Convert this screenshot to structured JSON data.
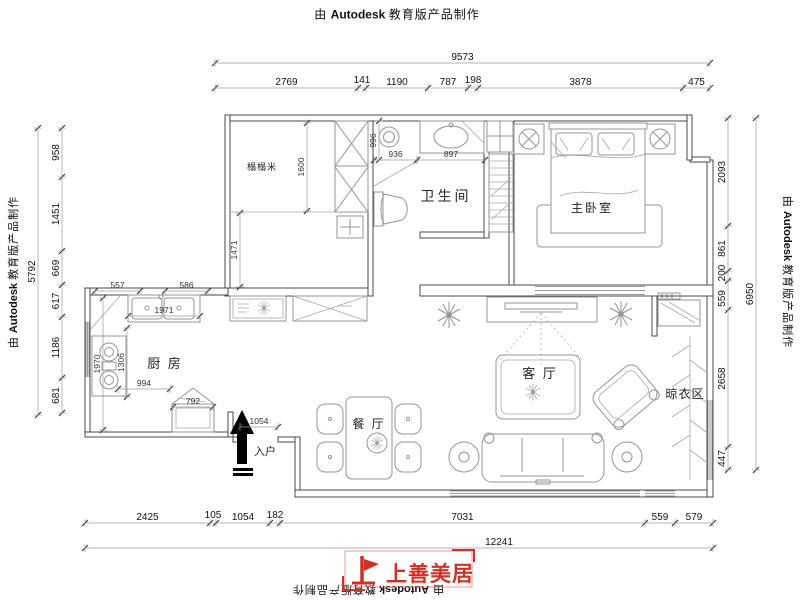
{
  "credit": {
    "pre": "由",
    "brand": "Autodesk",
    "post": "教育版产品制作"
  },
  "logo": {
    "name": "上善美居"
  },
  "rooms": {
    "tatami": "榻榻米",
    "bath": "卫生间",
    "master": "主卧室",
    "kitchen": "厨 房",
    "living": "客 厅",
    "dining": "餐 厅",
    "drying": "晾衣区",
    "entry": "入户"
  },
  "dims": {
    "top_total": "9573",
    "top": [
      "2769",
      "141",
      "1190",
      "787",
      "198",
      "3878",
      "475"
    ],
    "left_total": "5792",
    "left": [
      "958",
      "1451",
      "669",
      "617",
      "1186",
      "681"
    ],
    "right_total": "6950",
    "right": [
      "2093",
      "861",
      "200",
      "559",
      "2658",
      "447"
    ],
    "bottom_total": "12241",
    "bottom": [
      "2425",
      "105",
      "1054",
      "182",
      "7031",
      "559",
      "579"
    ],
    "inner": {
      "tatami_depth": "1600",
      "hall": "1471",
      "bath_w": "996",
      "shower": "936",
      "basin": "897",
      "k_a": "557",
      "k_b": "586",
      "sink": "1971",
      "k_left": "1970",
      "k_mid": "1306",
      "k_low": "994",
      "cabinet": "792",
      "entry": "1054"
    }
  }
}
